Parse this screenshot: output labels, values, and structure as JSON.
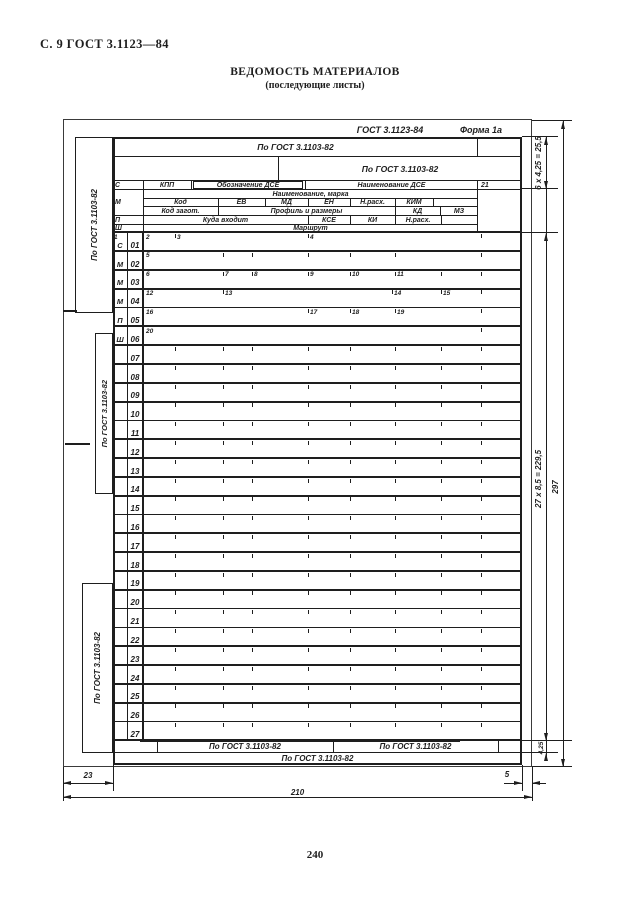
{
  "page": {
    "header_left": "С. 9 ГОСТ 3.1123—84",
    "title": "ВЕДОМОСТЬ МАТЕРИАЛОВ",
    "subtitle": "(последующие листы)",
    "page_number": "240"
  },
  "form": {
    "caption_standard": "ГОСТ 3.1123-84",
    "caption_form": "Форма 1а",
    "ink": "#1e1e1e",
    "header_cells": [
      {
        "n": "addr-row-1",
        "t": "По ГОСТ 3.1103-82",
        "x": 113,
        "y": 137,
        "w": 365,
        "h": 20,
        "a": "c",
        "fs": 8.5
      },
      {
        "n": "addr-row-2",
        "t": "По ГОСТ 3.1103-82",
        "x": 278,
        "y": 157,
        "w": 244,
        "h": 24,
        "a": "c",
        "fs": 8.5
      },
      {
        "n": "service-mark-s",
        "t": "С",
        "x": 115,
        "y": 181,
        "w": 26,
        "h": 9,
        "a": "l"
      },
      {
        "n": "col-kpp",
        "t": "КПП",
        "x": 143,
        "y": 181,
        "w": 48,
        "h": 9,
        "a": "c"
      },
      {
        "n": "col-oboznachenie-dse",
        "t": "Обозначение ДСЕ",
        "x": 193,
        "y": 181,
        "w": 110,
        "h": 8,
        "a": "c",
        "box": true
      },
      {
        "n": "col-naimenovanie-dse",
        "t": "Наименование ДСЕ",
        "x": 305,
        "y": 181,
        "w": 173,
        "h": 9,
        "a": "c"
      },
      {
        "n": "col-21",
        "t": "21",
        "x": 481,
        "y": 181,
        "w": 20,
        "h": 9,
        "a": "l"
      },
      {
        "n": "service-mark-m",
        "t": "М",
        "x": 115,
        "y": 196,
        "w": 26,
        "h": 14,
        "a": "l"
      },
      {
        "n": "col-naimenovanie-marka",
        "t": "Наименование, марка",
        "x": 143,
        "y": 190,
        "w": 335,
        "h": 9,
        "a": "c"
      },
      {
        "n": "col-kod",
        "t": "Код",
        "x": 143,
        "y": 199,
        "w": 75,
        "h": 8,
        "a": "c"
      },
      {
        "n": "col-ev",
        "t": "ЕВ",
        "x": 218,
        "y": 199,
        "w": 47,
        "h": 8,
        "a": "c"
      },
      {
        "n": "col-md",
        "t": "МД",
        "x": 265,
        "y": 199,
        "w": 43,
        "h": 8,
        "a": "c"
      },
      {
        "n": "col-en",
        "t": "ЕН",
        "x": 308,
        "y": 199,
        "w": 42,
        "h": 8,
        "a": "c"
      },
      {
        "n": "col-n-rash-1",
        "t": "Н.расх.",
        "x": 350,
        "y": 199,
        "w": 45,
        "h": 8,
        "a": "c"
      },
      {
        "n": "col-kim",
        "t": "КИМ",
        "x": 395,
        "y": 199,
        "w": 38,
        "h": 8,
        "a": "c"
      },
      {
        "n": "col-kod-zagot",
        "t": "Код загот.",
        "x": 143,
        "y": 207,
        "w": 75,
        "h": 9,
        "a": "c"
      },
      {
        "n": "col-profil-i-razmery",
        "t": "Профиль и размеры",
        "x": 218,
        "y": 207,
        "w": 177,
        "h": 9,
        "a": "c"
      },
      {
        "n": "col-kd",
        "t": "КД",
        "x": 395,
        "y": 207,
        "w": 45,
        "h": 9,
        "a": "c"
      },
      {
        "n": "col-mz",
        "t": "МЗ",
        "x": 440,
        "y": 207,
        "w": 38,
        "h": 9,
        "a": "c"
      },
      {
        "n": "service-mark-p",
        "t": "П",
        "x": 115,
        "y": 216,
        "w": 26,
        "h": 9,
        "a": "l"
      },
      {
        "n": "col-kuda-vhodit",
        "t": "Куда входит",
        "x": 143,
        "y": 216,
        "w": 165,
        "h": 9,
        "a": "c"
      },
      {
        "n": "col-kse",
        "t": "КСЕ",
        "x": 308,
        "y": 216,
        "w": 42,
        "h": 9,
        "a": "c"
      },
      {
        "n": "col-ki",
        "t": "КИ",
        "x": 350,
        "y": 216,
        "w": 45,
        "h": 9,
        "a": "c"
      },
      {
        "n": "col-n-rash-2",
        "t": "Н.расх.",
        "x": 395,
        "y": 216,
        "w": 46,
        "h": 9,
        "a": "c"
      },
      {
        "n": "service-mark-sh",
        "t": "Ш",
        "x": 115,
        "y": 225,
        "w": 26,
        "h": 8,
        "a": "l"
      },
      {
        "n": "col-marshrut",
        "t": "Маршрут",
        "x": 143,
        "y": 225,
        "w": 335,
        "h": 8,
        "a": "c"
      }
    ],
    "side_boxes": [
      {
        "label": "По ГОСТ 3.1103-82",
        "x": 75,
        "y": 137,
        "w": 38,
        "h": 176
      },
      {
        "label": "По ГОСТ 3.1103-82",
        "x": 95,
        "y": 333,
        "w": 18,
        "h": 161
      },
      {
        "label": "По ГОСТ 3.1103-82",
        "x": 82,
        "y": 583,
        "w": 31,
        "h": 170
      }
    ],
    "rows": [
      {
        "num": "01",
        "letter": "С",
        "sups": [
          [
            "1",
            113,
            0
          ],
          [
            "2",
            145,
            0
          ],
          [
            "3",
            175,
            1
          ],
          [
            "4",
            308,
            1
          ]
        ],
        "ticks": [
          481
        ]
      },
      {
        "num": "02",
        "letter": "М",
        "sups": [
          [
            "5",
            145,
            0
          ]
        ],
        "ticks": [
          223,
          252,
          308,
          350,
          395,
          481
        ]
      },
      {
        "num": "03",
        "letter": "М",
        "sups": [
          [
            "6",
            145,
            0
          ],
          [
            "7",
            223,
            1
          ],
          [
            "8",
            252,
            1
          ],
          [
            "9",
            308,
            1
          ],
          [
            "10",
            350,
            1
          ],
          [
            "11",
            395,
            1
          ]
        ],
        "ticks": [
          441,
          481
        ]
      },
      {
        "num": "04",
        "letter": "М",
        "sups": [
          [
            "12",
            145,
            0
          ],
          [
            "13",
            223,
            1
          ],
          [
            "14",
            392,
            1
          ],
          [
            "15",
            441,
            1
          ]
        ],
        "ticks": [
          481
        ]
      },
      {
        "num": "05",
        "letter": "П",
        "sups": [
          [
            "16",
            145,
            0
          ],
          [
            "17",
            308,
            1
          ],
          [
            "18",
            350,
            1
          ],
          [
            "19",
            395,
            1
          ]
        ],
        "ticks": [
          481
        ]
      },
      {
        "num": "06",
        "letter": "Ш",
        "sups": [
          [
            "20",
            145,
            0
          ]
        ],
        "ticks": [
          481
        ]
      },
      {
        "num": "07"
      },
      {
        "num": "08"
      },
      {
        "num": "09"
      },
      {
        "num": "10"
      },
      {
        "num": "11"
      },
      {
        "num": "12"
      },
      {
        "num": "13"
      },
      {
        "num": "14"
      },
      {
        "num": "15"
      },
      {
        "num": "16"
      },
      {
        "num": "17"
      },
      {
        "num": "18"
      },
      {
        "num": "19"
      },
      {
        "num": "20"
      },
      {
        "num": "21"
      },
      {
        "num": "22"
      },
      {
        "num": "23"
      },
      {
        "num": "24"
      },
      {
        "num": "25"
      },
      {
        "num": "26"
      },
      {
        "num": "27"
      }
    ],
    "std_ticks": [
      175,
      223,
      252,
      308,
      350,
      395,
      441,
      481
    ],
    "footer": {
      "row1": [
        "По ГОСТ 3.1103-82",
        "По ГОСТ 3.1103-82"
      ],
      "row2": "По ГОСТ 3.1103-82"
    },
    "dimensions": {
      "header_block": "6 х 4,25 = 25,5",
      "data_rows": "27 х 8,5 = 229,5",
      "sheet_height": "297",
      "footer_row": "4,25",
      "left_margin": "23",
      "sheet_width": "210",
      "right_margin": "5"
    }
  }
}
